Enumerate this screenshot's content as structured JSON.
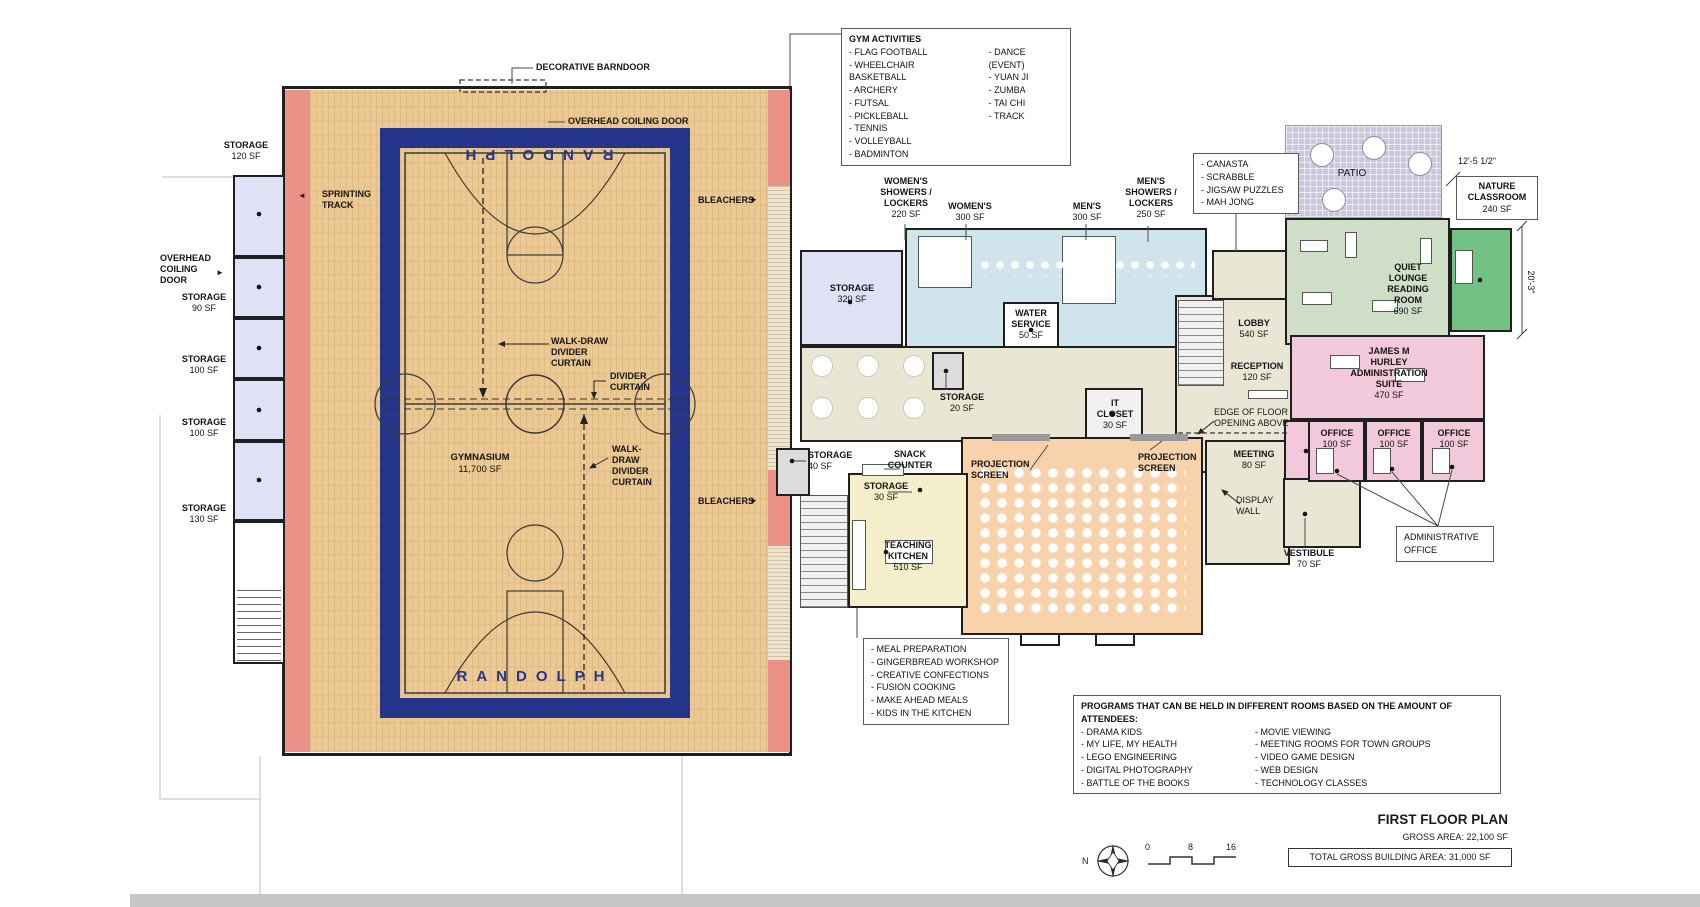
{
  "plan_title": {
    "title": "FIRST FLOOR PLAN",
    "gross": "GROSS AREA: 22,100 SF",
    "total": "TOTAL GROSS BUILDING AREA: 31,000 SF",
    "north": "N",
    "scale_ticks": [
      "0",
      "8",
      "16"
    ]
  },
  "icons": {
    "arrow_left": "◄",
    "arrow_right": "►"
  },
  "gym": {
    "randolph": "RANDOLPH",
    "name": "GYMNASIUM",
    "area": "11,700 SF",
    "sprinting_track": "SPRINTING\nTRACK",
    "bleachers": "BLEACHERS",
    "walk_draw_a": "WALK-DRAW DIVIDER\nCURTAIN",
    "divider": "DIVIDER\nCURTAIN",
    "walk_draw_b": "WALK-DRAW\nDIVIDER\nCURTAIN",
    "decorative_barndoor": "DECORATIVE BARNDOOR",
    "overhead_coiling_top": "OVERHEAD COILING DOOR",
    "overhead_coiling_left": "OVERHEAD\nCOILING\nDOOR"
  },
  "rooms": {
    "storage_120": {
      "name": "STORAGE",
      "area": "120 SF"
    },
    "storage_90": {
      "name": "STORAGE",
      "area": "90 SF"
    },
    "storage_100": {
      "name": "STORAGE",
      "area": "100 SF"
    },
    "storage_130": {
      "name": "STORAGE",
      "area": "130 SF"
    },
    "storage_320": {
      "name": "STORAGE",
      "area": "320 SF"
    },
    "womens_showers": {
      "name": "WOMEN'S\nSHOWERS /\nLOCKERS",
      "area": "220 SF"
    },
    "womens": {
      "name": "WOMEN'S",
      "area": "300 SF"
    },
    "mens": {
      "name": "MEN'S",
      "area": "300 SF"
    },
    "mens_showers": {
      "name": "MEN'S\nSHOWERS /\nLOCKERS",
      "area": "250 SF"
    },
    "water_service": {
      "name": "WATER\nSERVICE",
      "area": "50 SF"
    },
    "storage_20": {
      "name": "STORAGE",
      "area": "20 SF"
    },
    "it_closet": {
      "name": "IT\nCLOSET",
      "area": "30 SF"
    },
    "storage_40": {
      "name": "STORAGE",
      "area": "40 SF"
    },
    "snack_counter": {
      "name": "SNACK\nCOUNTER"
    },
    "storage_30": {
      "name": "STORAGE",
      "area": "30 SF"
    },
    "teaching_kitchen": {
      "name": "TEACHING\nKITCHEN",
      "area": "510 SF"
    },
    "projection_screen": {
      "name": "PROJECTION\nSCREEN"
    },
    "lobby": {
      "name": "LOBBY",
      "area": "540 SF"
    },
    "reception": {
      "name": "RECEPTION",
      "area": "120 SF"
    },
    "edge_note": {
      "name": "EDGE OF FLOOR\nOPENING ABOVE"
    },
    "meeting": {
      "name": "MEETING",
      "area": "80 SF"
    },
    "display_wall": {
      "name": "DISPLAY\nWALL"
    },
    "vestibule": {
      "name": "VESTIBULE",
      "area": "70 SF"
    },
    "patio": {
      "name": "PATIO"
    },
    "quiet_lounge": {
      "name": "QUIET\nLOUNGE\nREADING\nROOM",
      "area": "690 SF"
    },
    "nature_classroom": {
      "name": "NATURE\nCLASSROOM",
      "area": "240 SF"
    },
    "admin_suite": {
      "name": "JAMES M\nHURLEY\nADMINISTRATION\nSUITE",
      "area": "470 SF"
    },
    "office": {
      "name": "OFFICE",
      "area": "100 SF"
    },
    "administrative_office": {
      "name": "ADMINISTRATIVE\nOFFICE"
    }
  },
  "dimensions": {
    "patio_width": "12'-5 1/2\"",
    "lounge_depth": "20'-3\""
  },
  "notes": {
    "gym_activities": {
      "title": "GYM ACTIVITIES",
      "col1": [
        "FLAG FOOTBALL",
        "WHEELCHAIR BASKETBALL",
        "ARCHERY",
        "FUTSAL",
        "PICKLEBALL",
        "TENNIS",
        "VOLLEYBALL",
        "BADMINTON"
      ],
      "col2": [
        "DANCE (EVENT)",
        "YUAN JI",
        "ZUMBA",
        "TAI CHI",
        "TRACK"
      ]
    },
    "lounge_games": {
      "items": [
        "CANASTA",
        "SCRABBLE",
        "JIGSAW PUZZLES",
        "MAH JONG"
      ]
    },
    "kitchen_programs": {
      "items": [
        "MEAL PREPARATION",
        "GINGERBREAD WORKSHOP",
        "CREATIVE CONFECTIONS",
        "FUSION COOKING",
        "MAKE AHEAD MEALS",
        "KIDS IN THE KITCHEN"
      ]
    },
    "room_programs": {
      "title": "PROGRAMS THAT CAN BE HELD IN DIFFERENT ROOMS BASED ON THE AMOUNT OF ATTENDEES:",
      "col1": [
        "DRAMA KIDS",
        "MY LIFE, MY HEALTH",
        "LEGO ENGINEERING",
        "DIGITAL PHOTOGRAPHY",
        "BATTLE OF THE BOOKS"
      ],
      "col2": [
        "MOVIE VIEWING",
        "MEETING ROOMS FOR TOWN GROUPS",
        "VIDEO GAME DESIGN",
        "WEB DESIGN",
        "TECHNOLOGY CLASSES"
      ]
    }
  },
  "colors": {
    "track_red": "#ea9288",
    "court_navy": "#25368a",
    "wood": "#ecc992",
    "locker_blue": "#cfe4ec",
    "corridor_beige": "#eae6d4",
    "multipurpose_peach": "#f8d2ab",
    "kitchen_yellow": "#f4efca",
    "lounge_sage": "#cfdec6",
    "nature_green": "#72c283",
    "admin_pink": "#f2c9da",
    "storage_lavender": "#dee2f4"
  }
}
